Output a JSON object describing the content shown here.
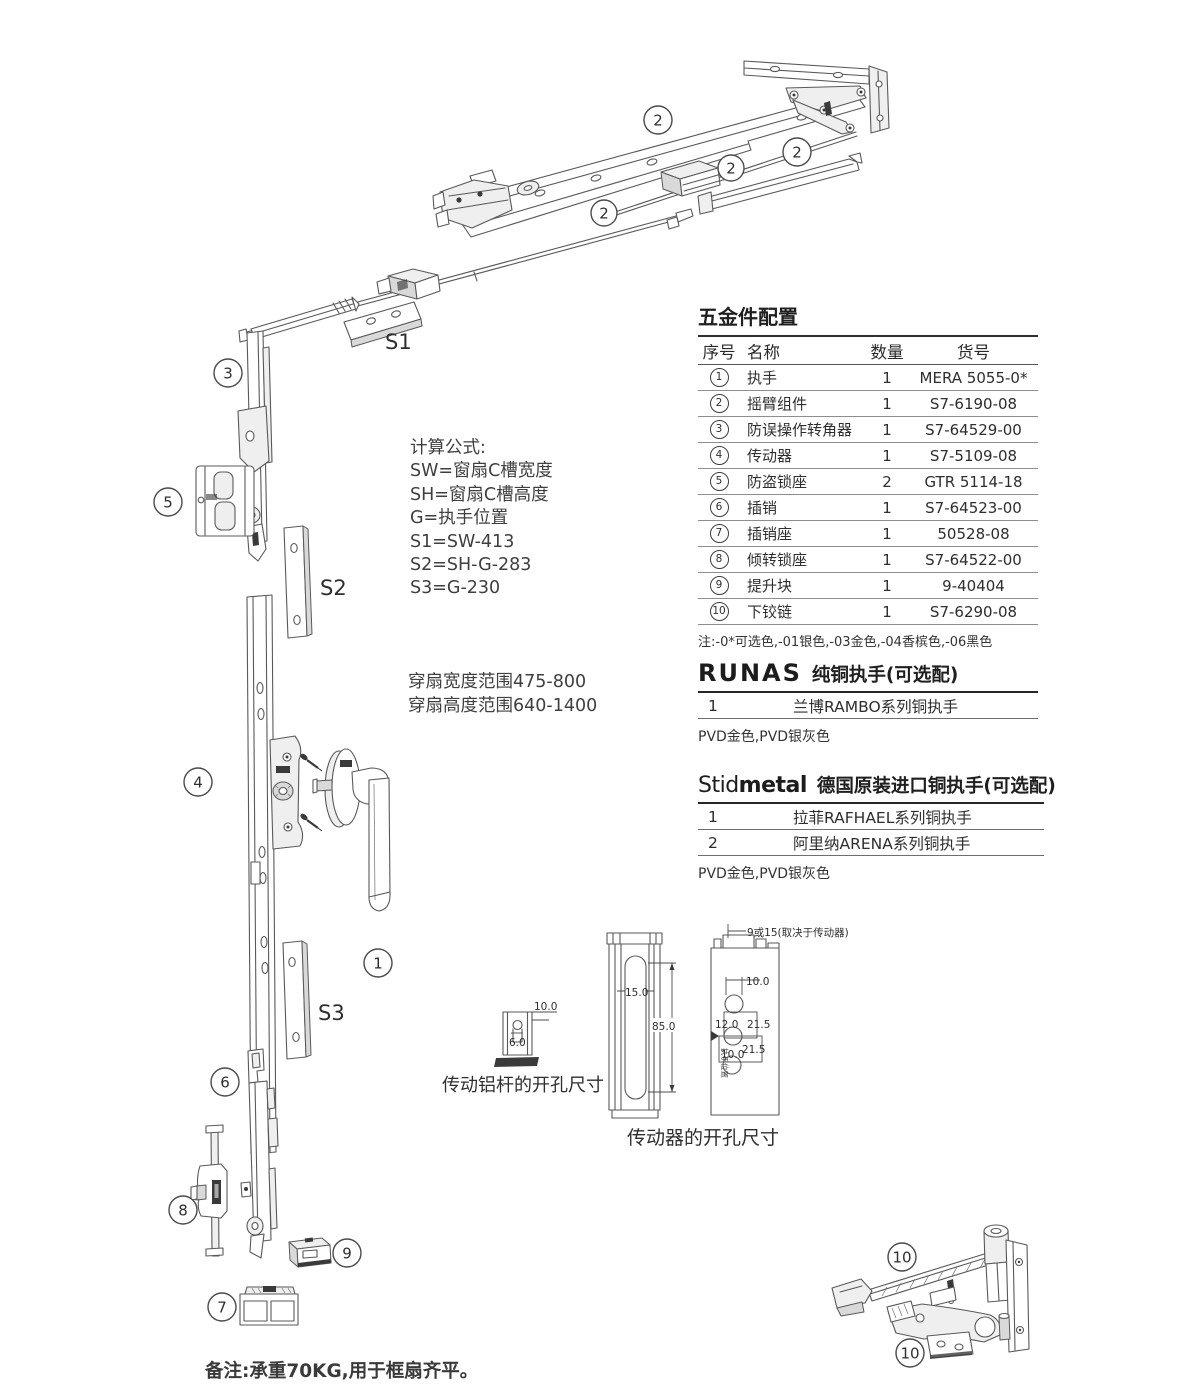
{
  "document": {
    "bottom_note": "备注:承重70KG,用于框扇齐平。"
  },
  "formulas": {
    "title": "计算公式:",
    "lines": [
      "SW=窗扇C槽宽度",
      "SH=窗扇C槽高度",
      "G=执手位置",
      "S1=SW-413",
      "S2=SH-G-283",
      "S3=G-230"
    ]
  },
  "ranges": {
    "line1": "穿扇宽度范围475-800",
    "line2": "穿扇高度范围640-1400"
  },
  "hardware_table": {
    "title": "五金件配置",
    "headers": {
      "no": "序号",
      "name": "名称",
      "qty": "数量",
      "code": "货号"
    },
    "rows": [
      {
        "no": "1",
        "name": "执手",
        "qty": "1",
        "code": "MERA 5055-0*"
      },
      {
        "no": "2",
        "name": "摇臂组件",
        "qty": "1",
        "code": "S7-6190-08"
      },
      {
        "no": "3",
        "name": "防误操作转角器",
        "qty": "1",
        "code": "S7-64529-00"
      },
      {
        "no": "4",
        "name": "传动器",
        "qty": "1",
        "code": "S7-5109-08"
      },
      {
        "no": "5",
        "name": "防盗锁座",
        "qty": "2",
        "code": "GTR 5114-18"
      },
      {
        "no": "6",
        "name": "插销",
        "qty": "1",
        "code": "S7-64523-00"
      },
      {
        "no": "7",
        "name": "插销座",
        "qty": "1",
        "code": "50528-08"
      },
      {
        "no": "8",
        "name": "倾转锁座",
        "qty": "1",
        "code": "S7-64522-00"
      },
      {
        "no": "9",
        "name": "提升块",
        "qty": "1",
        "code": "9-40404"
      },
      {
        "no": "10",
        "name": "下铰链",
        "qty": "1",
        "code": "S7-6290-08"
      }
    ],
    "note": "注:-0*可选色,-01银色,-03金色,-04香槟色,-06黑色"
  },
  "runas": {
    "brand": "RUNAS",
    "title": "纯铜执手(可选配)",
    "rows": [
      {
        "no": "1",
        "name": "兰博RAMBO系列铜执手"
      }
    ],
    "note": "PVD金色,PVD银灰色"
  },
  "stidmetal": {
    "brand_part1": "Stid",
    "brand_part2": "metal",
    "title": "德国原装进口铜执手(可选配)",
    "rows": [
      {
        "no": "1",
        "name": "拉菲RAFHAEL系列铜执手"
      },
      {
        "no": "2",
        "name": "阿里纳ARENA系列铜执手"
      }
    ],
    "note": "PVD金色,PVD银灰色"
  },
  "diagram": {
    "callouts": [
      {
        "n": "2"
      },
      {
        "n": "2"
      },
      {
        "n": "2"
      },
      {
        "n": "2"
      },
      {
        "n": "3"
      },
      {
        "n": "5"
      },
      {
        "n": "4"
      },
      {
        "n": "1"
      },
      {
        "n": "6"
      },
      {
        "n": "8"
      },
      {
        "n": "9"
      },
      {
        "n": "7"
      },
      {
        "n": "10"
      },
      {
        "n": "10"
      }
    ],
    "s_labels": {
      "s1": "S1",
      "s2": "S2",
      "s3": "S3"
    }
  },
  "dim_rod": {
    "caption": "传动铝杆的开孔尺寸",
    "w": "10.0",
    "inner": "6.0"
  },
  "dim_driver": {
    "caption": "传动器的开孔尺寸",
    "top": "9或15(取决于传动器)",
    "slot_width": "15.0",
    "slot_height": "85.0",
    "hole_top": "10.0",
    "hole_mid": "12.0",
    "offset_a": "21.5",
    "offset_b": "21.5",
    "hole_bot": "10.0",
    "side_label": "执手位置"
  }
}
